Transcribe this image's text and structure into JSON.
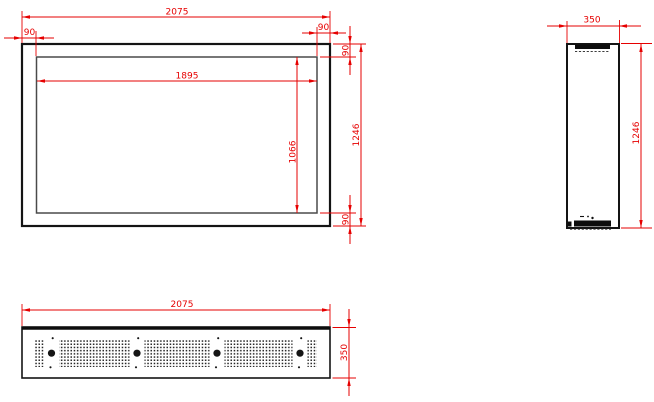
{
  "views": {
    "front": {
      "overall_width": "2075",
      "overall_height": "1246",
      "opening_width": "1895",
      "opening_height": "1066",
      "frame_left": "90",
      "frame_right": "90",
      "frame_top": "90",
      "frame_bottom": "90"
    },
    "side": {
      "depth": "350",
      "height": "1246"
    },
    "bottom": {
      "length": "2075",
      "depth": "350"
    }
  },
  "colors": {
    "dimension_red": "#e60000",
    "outline_black": "#141414"
  }
}
